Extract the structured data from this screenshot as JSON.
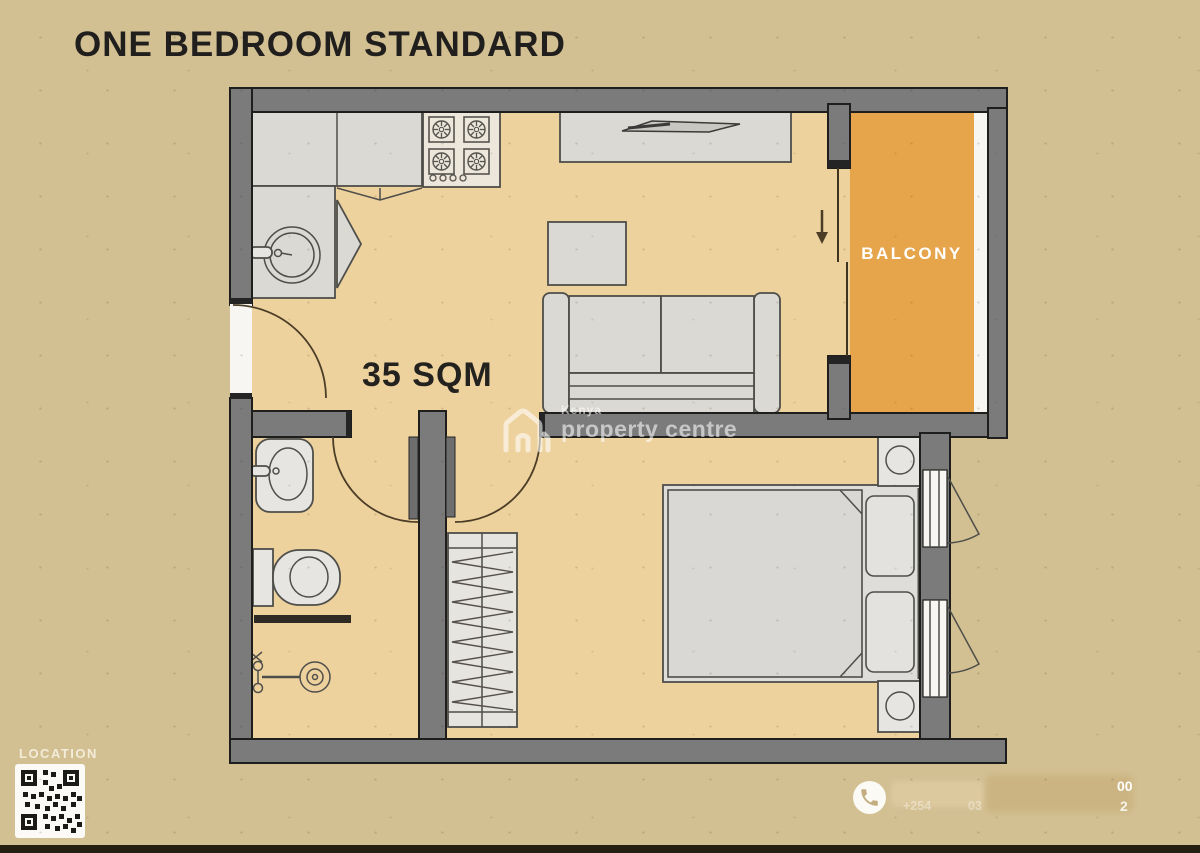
{
  "title": "ONE BEDROOM STANDARD",
  "plan": {
    "area_label": "35 SQM",
    "balcony_label": "BALCONY"
  },
  "watermark": {
    "line1": "Kenya",
    "line2": "property centre"
  },
  "footer": {
    "location_label": "LOCATION",
    "phone": {
      "prefix_fragment": "+254",
      "mid_fragment": "03",
      "top_right_fragment": "00",
      "bottom_right_fragment": "2"
    }
  },
  "icons": {
    "phone": "phone-icon",
    "qr": "qr-code",
    "watermark_logo": "house-logo-icon",
    "balcony_entry": "arrow-down-icon"
  },
  "colors": {
    "bg": "#d2bf92",
    "floor": "#eed29e",
    "balcony": "#e7a54b",
    "wall": "#7b7b7b",
    "wall-edge": "#1e1e1c",
    "furn": "#dbd9d4",
    "furn-edge": "#4e4e4a",
    "white": "#f7f6f2",
    "door": "#4b3d26",
    "title": "#201f1d",
    "watermark": "rgba(255,255,255,0.58)",
    "label-light": "#f3ecd9",
    "bottom-bar": "#241f10",
    "blur-a": "#deca9f",
    "blur-b": "#cbb481",
    "stove": "#ece7da",
    "screen-dark": "#2e2b24"
  }
}
